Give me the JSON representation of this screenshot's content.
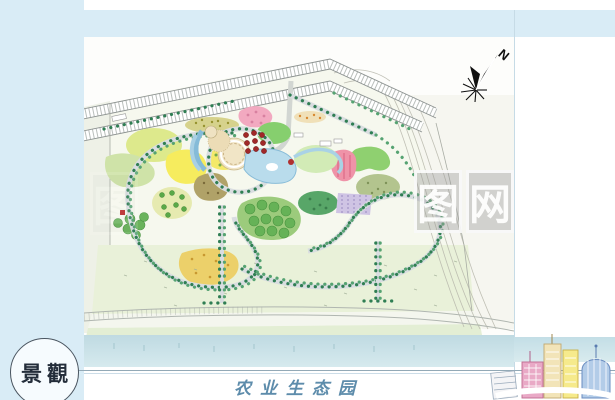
{
  "colors": {
    "frameBlue": "#d9ecf6",
    "dividerBlue": "#c6dbe6",
    "waterBand": "#c3dee6",
    "waterBandLight": "#d9ebee",
    "baseline": "#93a9b6",
    "stampInk": "#232d3a",
    "stampBorder": "#4a5560",
    "titleBlue": "#5d8cab",
    "compassInk": "#101010",
    "treeGreen": "#2f7e53",
    "pathGray": "#d9dde0",
    "roadTick": "#a2a8a4",
    "lakeBlue": "#b9dcec",
    "plazaCream": "#f1e5c6",
    "lawn": "#e9f1d9",
    "meadow": "#dde98c",
    "brightYellow": "#f6ec5e",
    "goldField": "#ecd06a",
    "pinkBloom": "#f2a9c0",
    "redHatch": "#ef93a8",
    "berryRed": "#a02828",
    "brightGreen": "#86cf6e",
    "forestGreen": "#66b257",
    "lavender": "#cfc4e4",
    "oliveDot": "#d6d28c",
    "brownMass": "#b0a268",
    "skyPink": "#e9a9c6",
    "skyCream": "#f2e4b8",
    "skyYellow": "#f6ea8c",
    "skyBlue": "#b3cce8"
  },
  "stamp": {
    "text": "景觀"
  },
  "title": {
    "text": "农业生态园"
  },
  "compass": {
    "label": "N"
  },
  "watermark": {
    "boxes": [
      {
        "char": "图"
      },
      {
        "char": "图"
      },
      {
        "char": "网"
      }
    ]
  }
}
